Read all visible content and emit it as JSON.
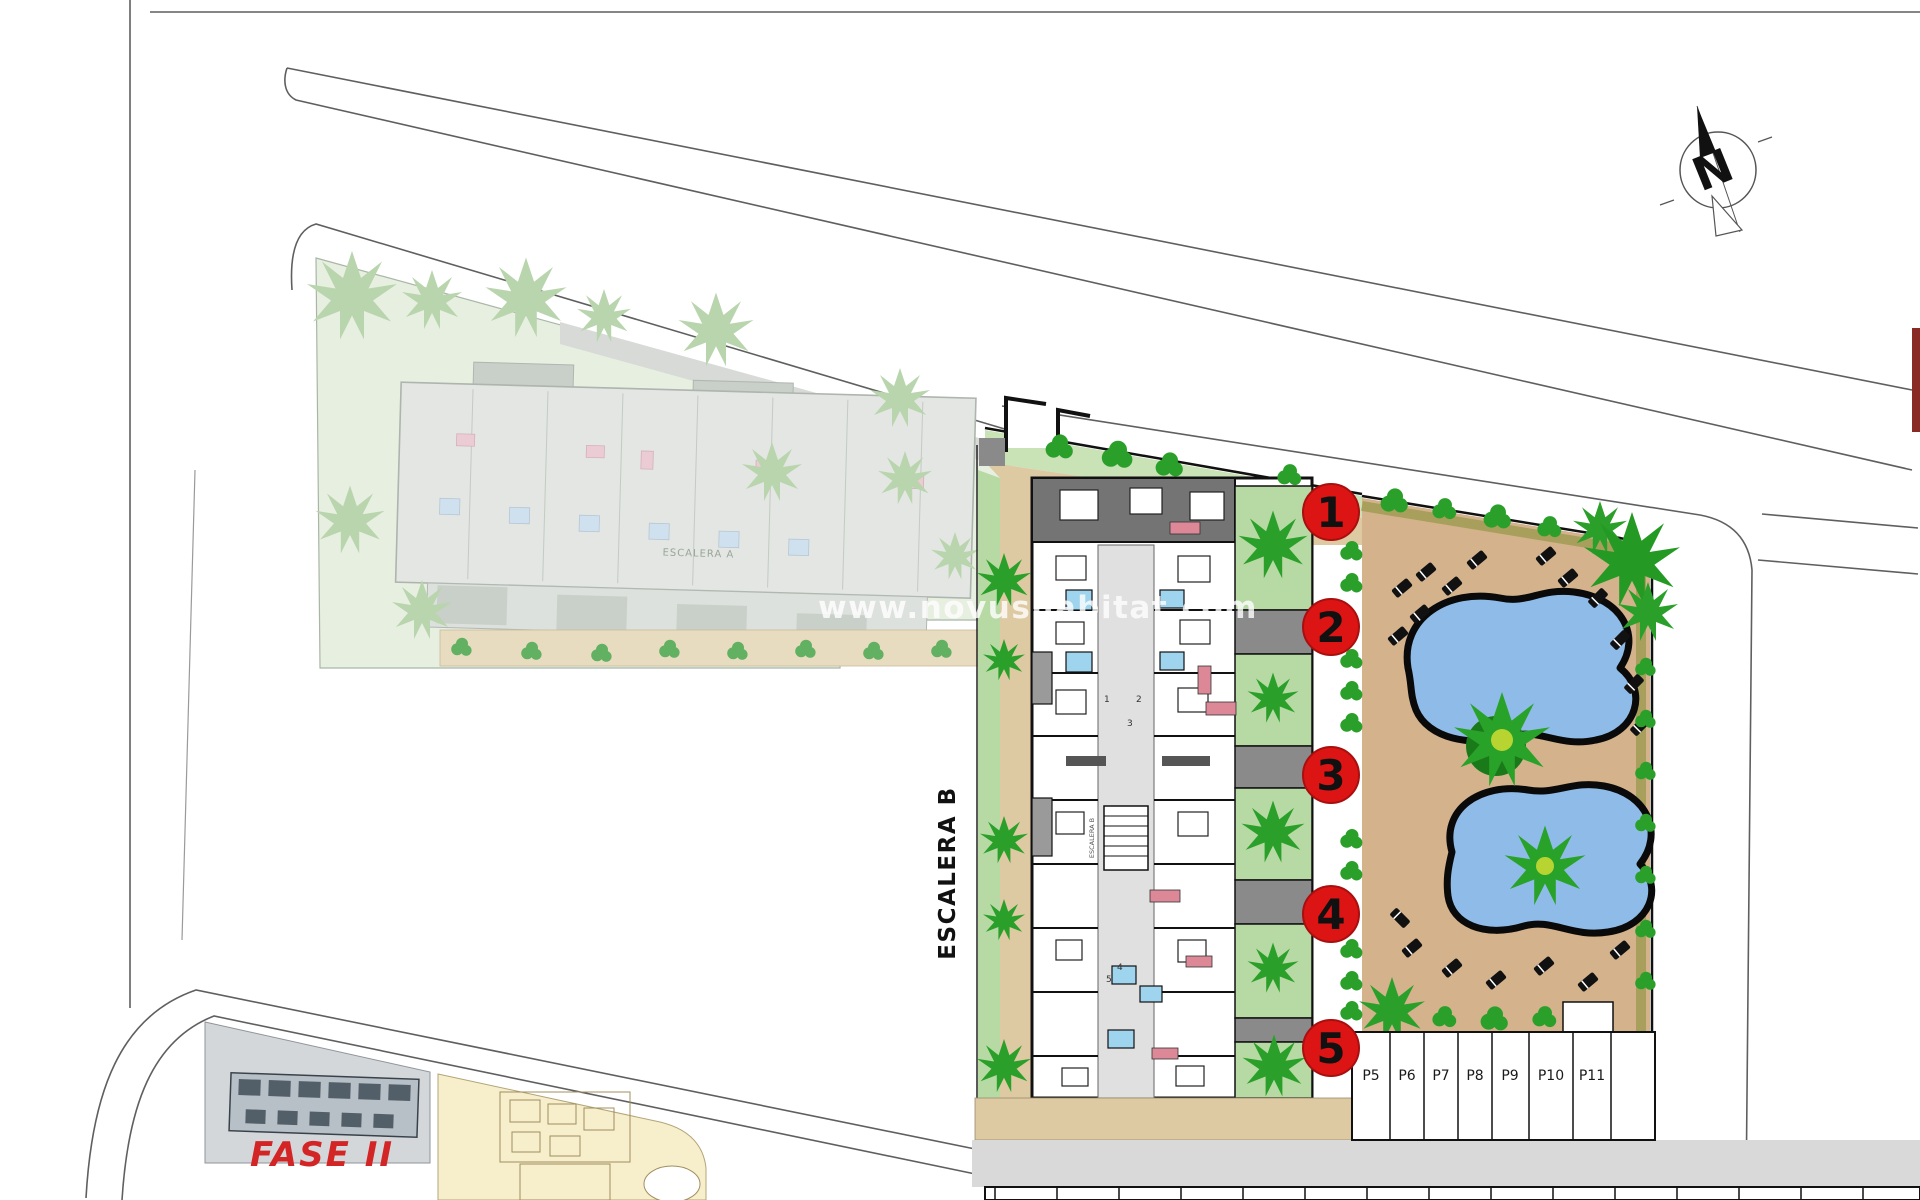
{
  "plan": {
    "watermark": "www.novushabitat.com",
    "phase2_label": "FASE II",
    "escalera_b_label": "ESCALERA B",
    "escalera_b_core_label": "ESCALERA B",
    "escalera_a_label": "ESCALERA A",
    "north_indicator": "N",
    "unit_markers": [
      "1",
      "2",
      "3",
      "4",
      "5"
    ],
    "corridor_unit_numbers": [
      "1",
      "2",
      "3",
      "4",
      "5"
    ],
    "parking_row_east": [
      "P5",
      "P6",
      "P7",
      "P8",
      "P9",
      "P10",
      "P11"
    ],
    "colors": {
      "marker_red": "#dd1414",
      "phase_label_red": "#d32525",
      "pool_water_blue": "#8fbbe8",
      "pool_deck_tan": "#d3b28c",
      "walkway_tan": "#ddc9a2",
      "lawn_green": "#c9e2b6",
      "garden_green": "#b7d9a3",
      "tree_green": "#2aa02a",
      "roof_terrace_gray": "#747474",
      "road_gray": "#d9d9d9",
      "phase1_faded_green": "#e7efe0",
      "phase2_plot_gray": "#d4d7da",
      "phase2_adjacent_cream": "#f7eecb"
    }
  }
}
